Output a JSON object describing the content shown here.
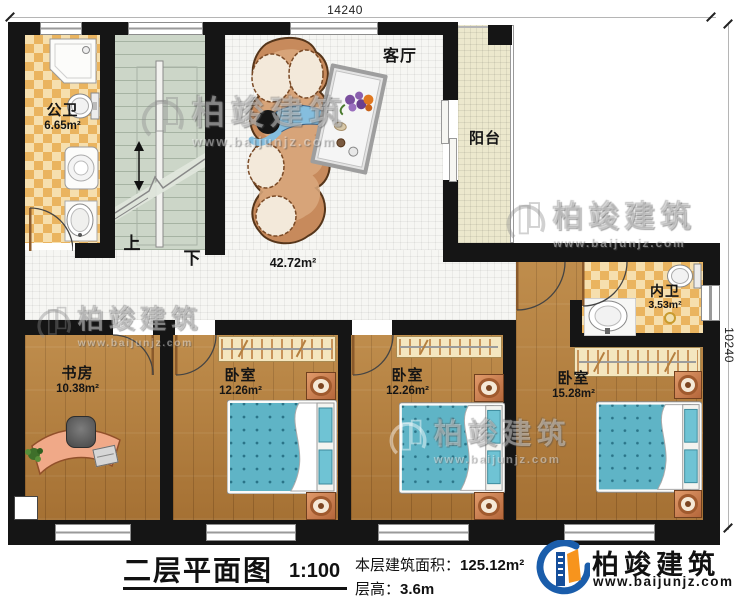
{
  "dimensions": {
    "top": "14240",
    "right": "10240"
  },
  "stairs": {
    "up": "上",
    "down": "下"
  },
  "rooms": {
    "gongwei": {
      "name": "公卫",
      "area": "6.65m²"
    },
    "keting": {
      "name": "客厅",
      "area": "42.72m²"
    },
    "yangtai": {
      "name": "阳台"
    },
    "neiwei": {
      "name": "内卫",
      "area": "3.53m²"
    },
    "shufang": {
      "name": "书房",
      "area": "10.38m²"
    },
    "woshi1": {
      "name": "卧室",
      "area": "12.26m²"
    },
    "woshi2": {
      "name": "卧室",
      "area": "12.26m²"
    },
    "woshi3": {
      "name": "卧室",
      "area": "15.28m²"
    }
  },
  "watermark": {
    "brand": "柏竣建筑",
    "url": "www.baijunjz.com"
  },
  "titleblock": {
    "title": "二层平面图",
    "scale": "1:100",
    "area_label": "本层建筑面积：",
    "area_value": "125.12m²",
    "height_label": "层高：",
    "height_value": "3.6m"
  },
  "logo": {
    "brand": "柏竣建筑",
    "url": "www.baijunjz.com"
  },
  "colors": {
    "brand_blue": "#1a5dab",
    "brand_orange": "#f7941d",
    "wall": "#151515",
    "bed": "#5fb4c6"
  }
}
